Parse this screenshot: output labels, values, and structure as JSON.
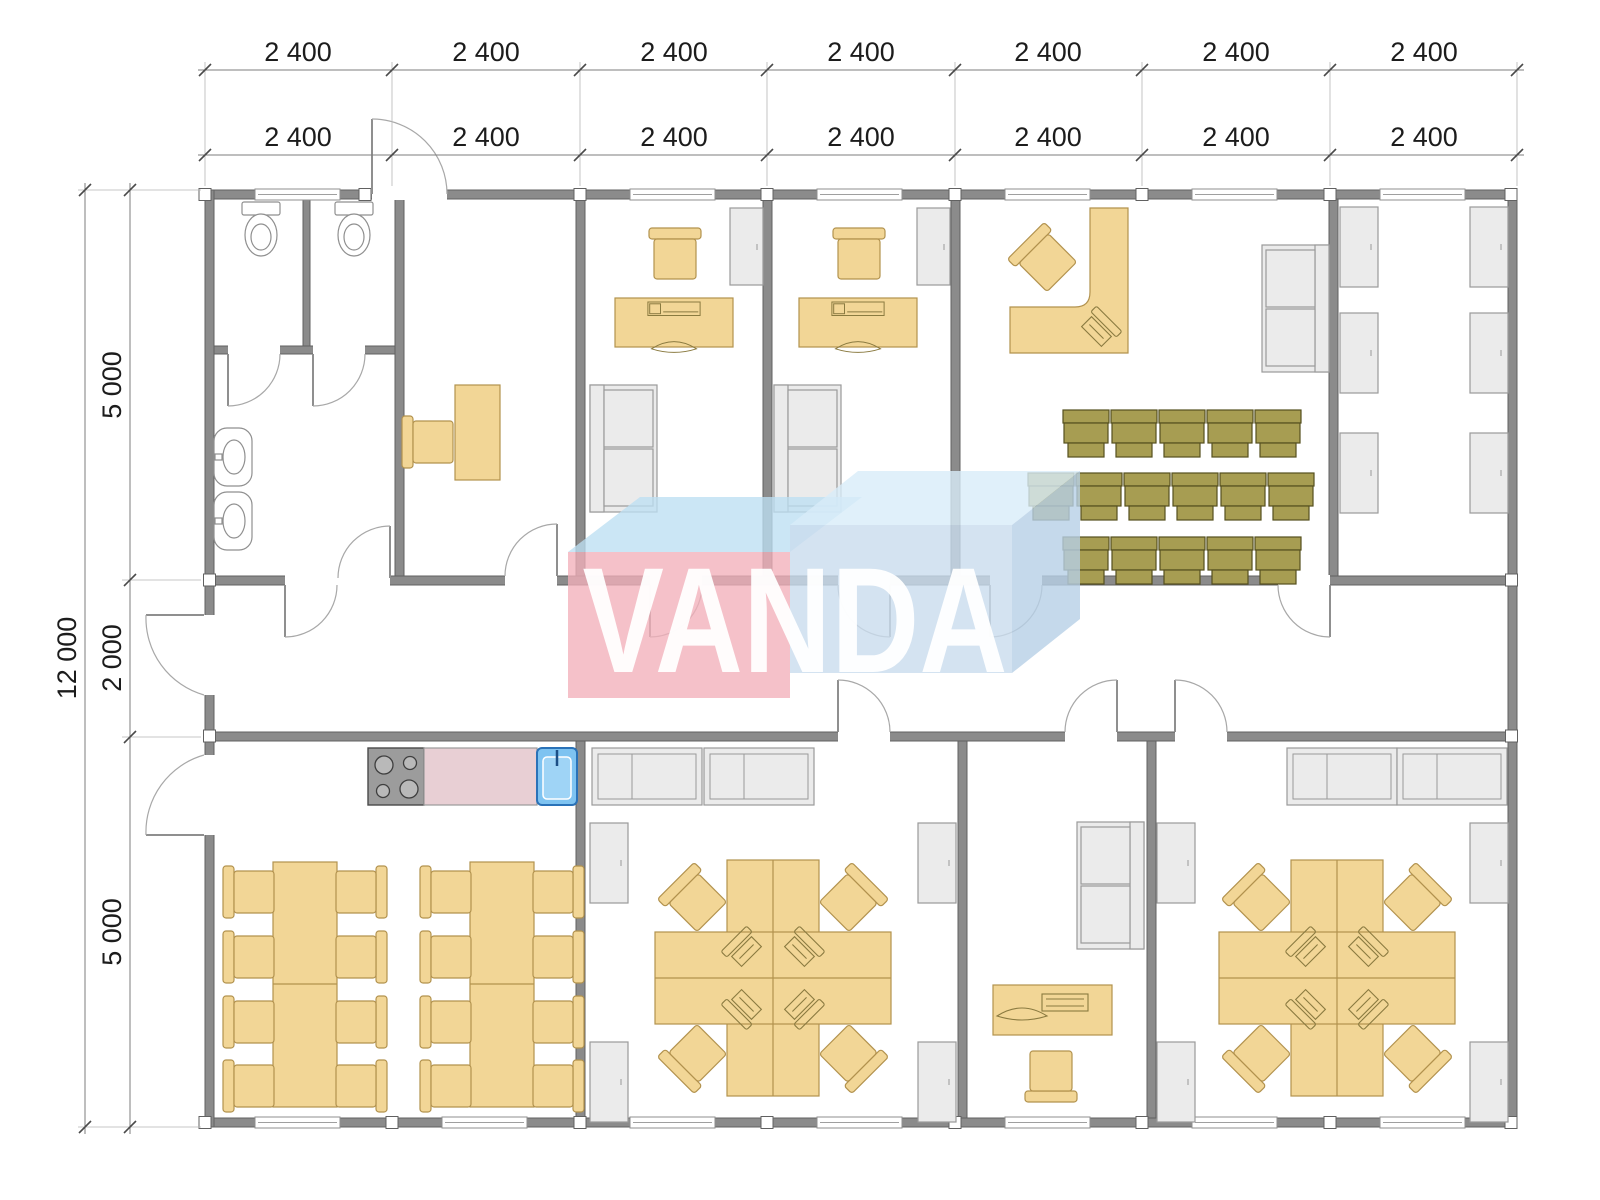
{
  "watermark": {
    "text": "VANDA"
  },
  "dimensions": {
    "top_row_outer": [
      "2 400",
      "2 400",
      "2 400",
      "2 400",
      "2 400",
      "2 400",
      "2 400"
    ],
    "top_row_inner": [
      "2 400",
      "2 400",
      "2 400",
      "2 400",
      "2 400",
      "2 400",
      "2 400"
    ],
    "left_overall": "12 000",
    "left_segments": [
      "5 000",
      "2 000",
      "5 000"
    ]
  },
  "colors": {
    "wall": "#8b8b8b",
    "wall-edge": "#616161",
    "furn": "#f2d696",
    "furn-edge": "#b2924e",
    "olive": "#a79d52",
    "olive-edge": "#55501f",
    "grayf": "#ebebeb",
    "grayf-edge": "#9a9a9a",
    "pinkc": "#e8cfd4",
    "sinkblue": "#7ec3f1",
    "sinkblue-dark": "#2a72b8",
    "wm-pink": "#f2afba",
    "wm-pink-top": "#bcdff2",
    "wm-blue": "#c9dcee",
    "wm-blue-top": "#d8ecf9",
    "wm-blue-side": "#b7cfe6"
  }
}
